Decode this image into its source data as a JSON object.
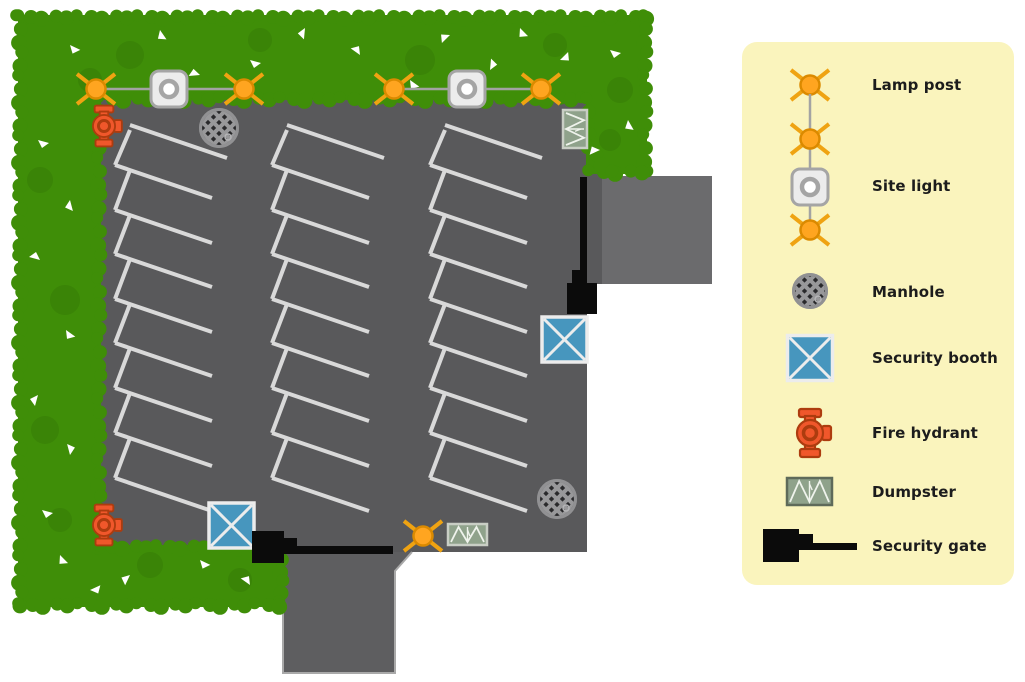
{
  "legend": {
    "panel_color": "#FAF4BD",
    "items": [
      {
        "label": "Lamp post",
        "icon": "lamp-post-icon"
      },
      {
        "label": "Site light",
        "icon": "site-light-icon"
      },
      {
        "label": "Manhole",
        "icon": "manhole-icon"
      },
      {
        "label": "Security booth",
        "icon": "security-booth-icon"
      },
      {
        "label": "Fire hydrant",
        "icon": "fire-hydrant-icon"
      },
      {
        "label": "Dumpster",
        "icon": "dumpster-icon"
      },
      {
        "label": "Security gate",
        "icon": "security-gate-icon"
      }
    ]
  },
  "plan": {
    "colors": {
      "grass": "#3F8E08",
      "grass_shadow": "#2E6C05",
      "asphalt": "#59595B",
      "road_right": "#6B6B6D",
      "road_bottom": "#5E5E60",
      "road_border": "#A9A9A9",
      "stall_line": "#D9D9D9",
      "chain_line": "#A3A3A3",
      "lamp_arm": "#EFA312",
      "lamp_bulb": "#FFA520",
      "lamp_bulb_stroke": "#DB8A00",
      "site_light_fill": "#ECECEC",
      "site_light_stroke": "#A5A5A5",
      "manhole_ring": "#919193",
      "manhole_dark": "#29292B",
      "manhole_grid": "#98989A",
      "booth_fill": "#4796BE",
      "booth_stroke": "#ECECEC",
      "hydrant_fill": "#F0572B",
      "hydrant_stroke": "#AD3C0F",
      "dumpster_fill": "#8FA28B",
      "dumpster_border_plan": "#C9CEC5",
      "dumpster_border_legend": "#5E6A5A",
      "dumpster_pattern": "#EFF3EC",
      "gate": "#0B0B0B"
    },
    "lamp_posts": [
      {
        "x": 96,
        "y": 89
      },
      {
        "x": 244,
        "y": 89
      },
      {
        "x": 394,
        "y": 89
      },
      {
        "x": 541,
        "y": 89
      },
      {
        "x": 423,
        "y": 536
      }
    ],
    "site_lights": [
      {
        "x": 169,
        "y": 89
      },
      {
        "x": 467,
        "y": 89
      }
    ],
    "light_chains": [
      {
        "x1": 96,
        "y1": 89,
        "x2": 244,
        "y2": 89
      },
      {
        "x1": 394,
        "y1": 89,
        "x2": 541,
        "y2": 89
      }
    ],
    "manholes": [
      {
        "x": 219,
        "y": 128,
        "r": 20
      },
      {
        "x": 557,
        "y": 499,
        "r": 20
      }
    ],
    "security_booths": [
      {
        "x": 542,
        "y": 317,
        "size": 45
      },
      {
        "x": 209,
        "y": 503,
        "size": 45
      }
    ],
    "fire_hydrants": [
      {
        "x": 104,
        "y": 126
      },
      {
        "x": 104,
        "y": 525
      }
    ],
    "dumpsters": [
      {
        "x": 563,
        "y": 110,
        "w": 24,
        "h": 38,
        "vertical": true
      },
      {
        "x": 448,
        "y": 524,
        "w": 39,
        "h": 21,
        "vertical": false
      }
    ],
    "security_gates": [
      {
        "square": [
          567,
          283,
          30,
          31
        ],
        "arm": [
          580,
          177,
          7,
          107
        ],
        "notch": [
          572,
          270,
          9,
          13
        ]
      },
      {
        "square": [
          252,
          531,
          32,
          32
        ],
        "arm": [
          284,
          546,
          109,
          8
        ],
        "notch": [
          284,
          538,
          13,
          8
        ]
      }
    ],
    "parking": {
      "column_x": [
        115,
        272,
        430
      ],
      "row_start_ys": [
        125,
        165,
        210,
        254,
        299,
        343,
        388,
        433,
        478
      ],
      "slant_dx": 97,
      "slant_dy": 33,
      "edge_dx": 15
    }
  }
}
